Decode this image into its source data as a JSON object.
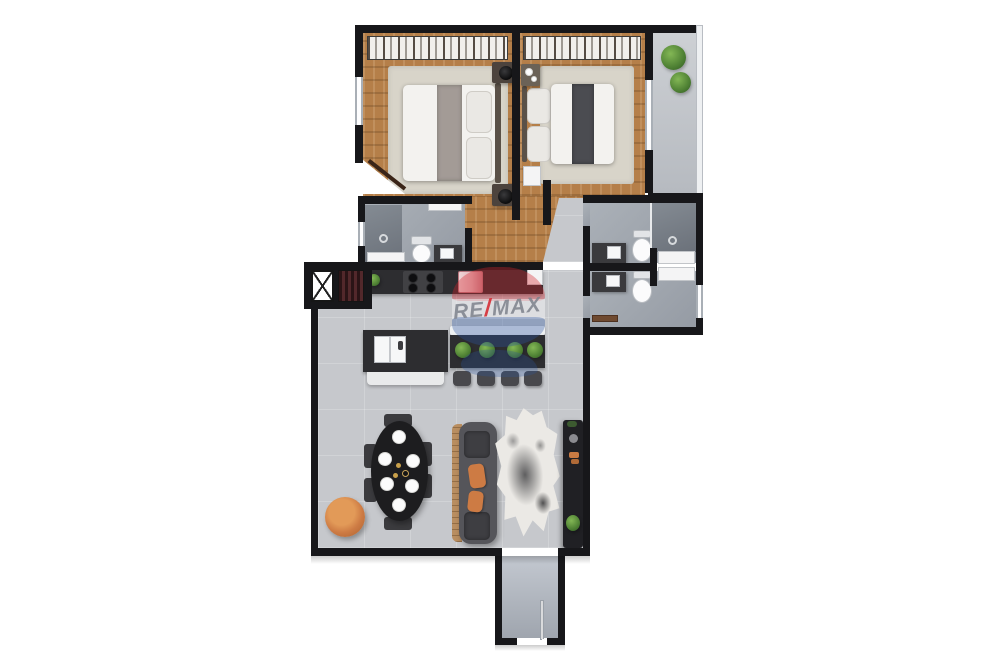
{
  "watermark": {
    "re": "RE",
    "slash": "/",
    "max": "MAX"
  },
  "colors": {
    "wall": "#17171a",
    "wood": "#b57f49",
    "concrete": "#c6c8cc",
    "bath_floor": "#a3a9b0",
    "shower": "#7b828a",
    "rug": "#d8d4c9",
    "mattress": "#f3f2ef",
    "pillow": "#eae8e4",
    "runner_light": "#a39b96",
    "runner_dark": "#4b4c51",
    "headboard": "#5a5148",
    "dark_furniture": "#2d2d30",
    "vanity": "#3a3a3d",
    "fixture_white": "#f4f4f5",
    "sofa": "#55555a",
    "sofa_cushion": "#3e3e42",
    "sofa_wood": "#b98e60",
    "orange": "#cd7b44",
    "plant": "#5d8f3f",
    "stairs_dark": "#2a1416",
    "stairs_light": "#52282b",
    "fridge_pink": "#e3b7bb",
    "tv_unit": "#202024",
    "wm_red": "#d5232b",
    "wm_blue": "#2c55a0",
    "wm_white": "#f3f4f6",
    "wm_text": "#7d828c"
  }
}
